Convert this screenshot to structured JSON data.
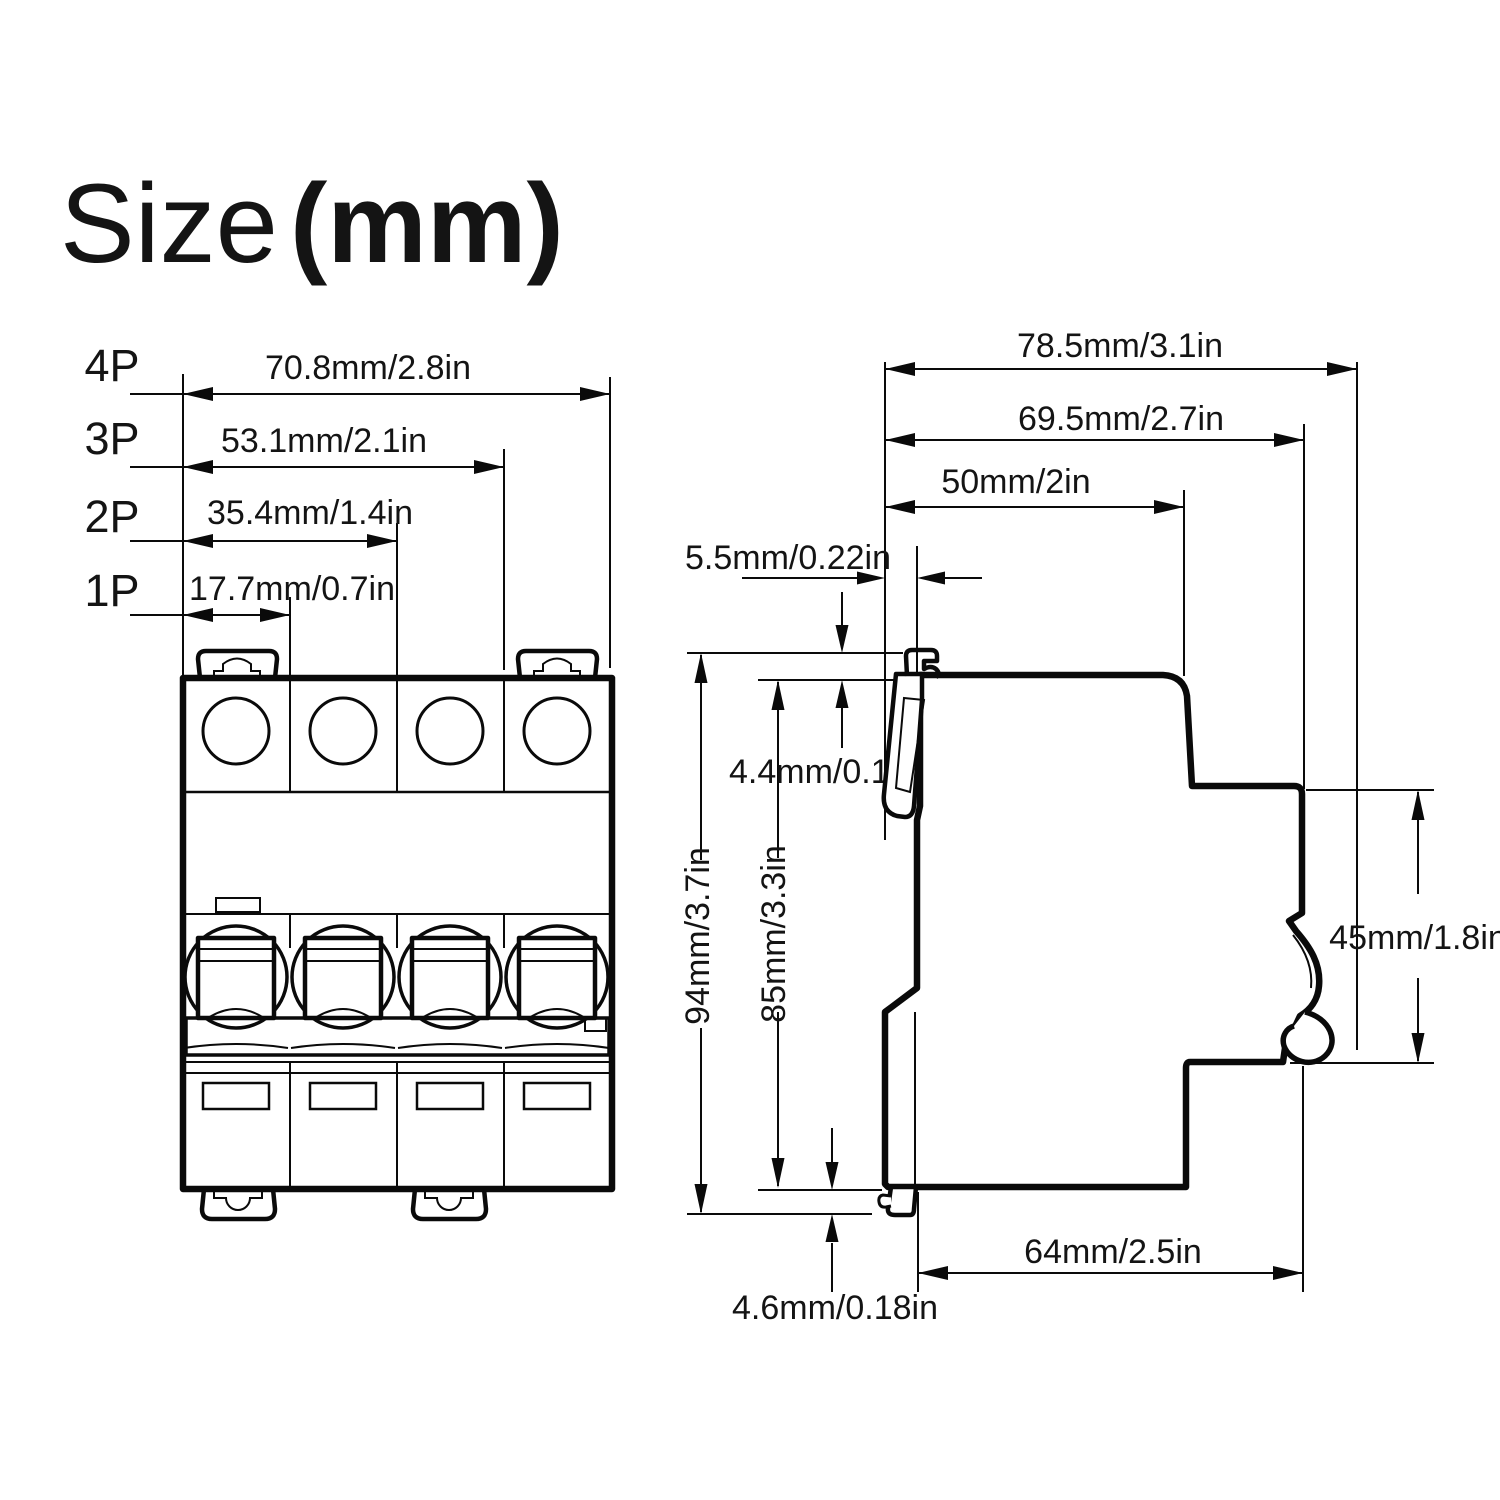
{
  "title": {
    "size": "Size",
    "unit": "(mm)"
  },
  "front_view": {
    "description": "miniature circuit breaker front view, 4 poles",
    "rows": [
      {
        "label": "4P",
        "dimension": "70.8mm/2.8in"
      },
      {
        "label": "3P",
        "dimension": "53.1mm/2.1in"
      },
      {
        "label": "2P",
        "dimension": "35.4mm/1.4in"
      },
      {
        "label": "1P",
        "dimension": "17.7mm/0.7in"
      }
    ]
  },
  "side_view": {
    "description": "miniature circuit breaker side view with DIN rail clip",
    "dims": {
      "total_depth": "78.5mm/3.1in",
      "body_depth": "69.5mm/2.7in",
      "front_depth": "50mm/2in",
      "clip_offset": "5.5mm/0.22in",
      "clip_top_protrusion": "4.4mm/0.17in",
      "total_height": "94mm/3.7in",
      "body_height": "85mm/3.3in",
      "handle_zone_height": "45mm/1.8in",
      "base_depth": "64mm/2.5in",
      "clip_bottom_protrusion": "4.6mm/0.18in"
    }
  },
  "colors": {
    "line": "#0a0a0a",
    "background": "#ffffff",
    "text": "#141414"
  }
}
